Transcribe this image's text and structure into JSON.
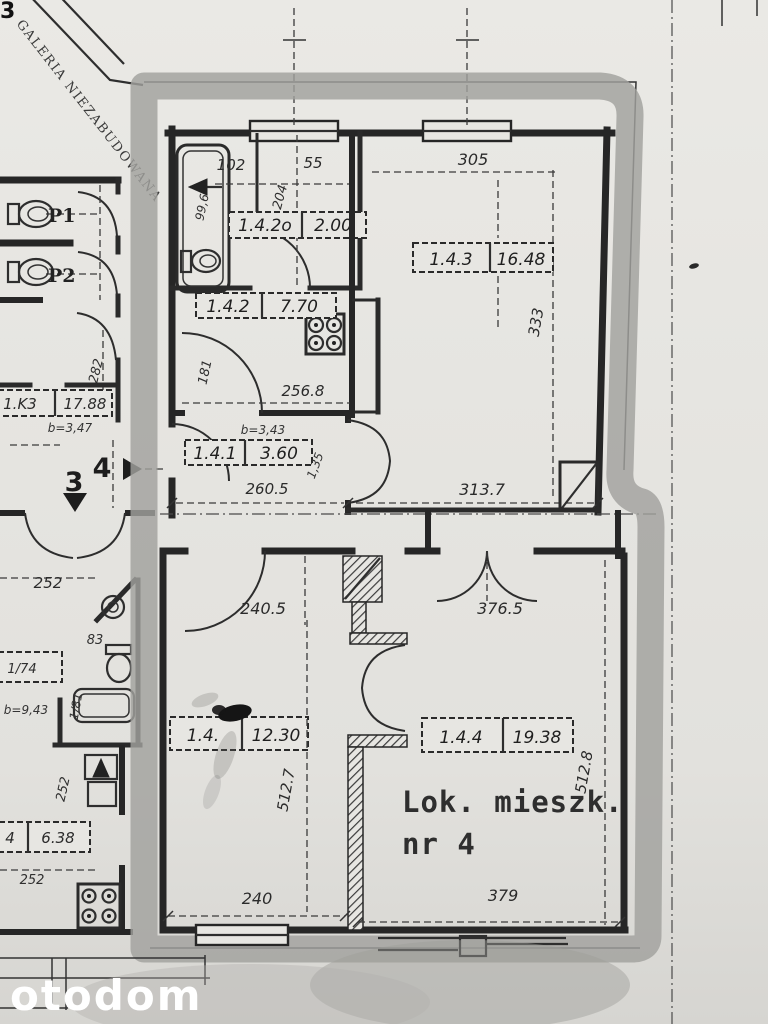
{
  "watermark": "otodom",
  "corner_mark": "3",
  "diagonal_label": "GALERIA NIEZABUDOWANA",
  "unit_caption": {
    "line1": "Lok. mieszk.",
    "line2": "nr 4"
  },
  "apartment_rooms": [
    {
      "id": "1.4.2o",
      "area": "2.00"
    },
    {
      "id": "1.4.2",
      "area": "7.70"
    },
    {
      "id": "1.4.1",
      "area": "3.60"
    },
    {
      "id": "1.4.3",
      "area": "16.48"
    },
    {
      "id": "1.4.",
      "area": "12.30"
    },
    {
      "id": "1.4.4",
      "area": "19.38"
    }
  ],
  "neighbor_labels": {
    "stairwell": {
      "id": "1.K3",
      "area": "17.88"
    },
    "small_room": {
      "id": "4",
      "area": "6.38"
    },
    "cell": "1/74",
    "wc1": "P1",
    "wc2": "P2",
    "bath_dim": "83",
    "floor_down": "3",
    "floor_up": "4"
  },
  "ceiling_heights": {
    "stair": "b=3,47",
    "hall": "b=3,43",
    "lower": "b=9,43"
  },
  "dimensions": {
    "bath_w1": "102",
    "bath_w2": "55",
    "bath_d": "204",
    "tub_len": "99,6",
    "room3_w": "305",
    "room3_d": "333",
    "room3_wb": "313.7",
    "kitchen_w": "256.8",
    "kitchen_d": "181",
    "hall_w": "260.5",
    "hall_n": "1,35",
    "room2_top_w": "240.5",
    "room4_top_w": "376.5",
    "room2_d": "512.7",
    "room4_d": "512.8",
    "room2_w": "240",
    "room4_w": "379",
    "left_d": "282",
    "left_252a": "252",
    "left_252b": "252",
    "left_252c": "252",
    "tub2": "1/81"
  },
  "colors": {
    "paper": "#e7e6e2",
    "ink": "#262626",
    "highlight_band": "#a1a19e",
    "watermark_text": "#ffffff"
  }
}
